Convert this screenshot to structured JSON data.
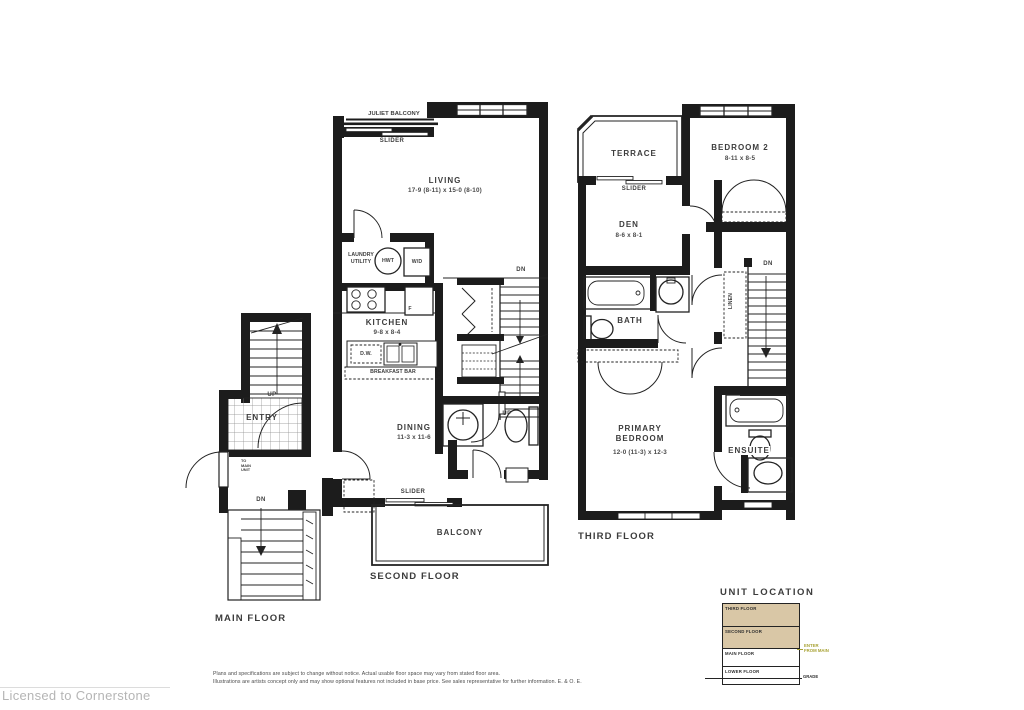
{
  "second_floor": {
    "title": "SECOND FLOOR",
    "juliet_balcony": "JULIET BALCONY",
    "slider_top": "SLIDER",
    "living_name": "LIVING",
    "living_dims": "17-9 (8-11) x 15-0 (8-10)",
    "laundry_line1": "LAUNDRY",
    "laundry_line2": "UTILITY",
    "hwt": "HWT",
    "washer_dryer": "W/D",
    "stairs_dn": "DN",
    "stairs_up": "UP",
    "kitchen_name": "KITCHEN",
    "kitchen_dims": "9-8 x 8-4",
    "fridge": "F",
    "dishwasher": "D.W.",
    "breakfast_bar": "BREAKFAST BAR",
    "dining_name": "DINING",
    "dining_dims": "11-3 x 11-6",
    "slider_bottom": "SLIDER",
    "balcony_name": "BALCONY"
  },
  "main_floor": {
    "title": "MAIN FLOOR",
    "stairs_up": "UP",
    "entry_name": "ENTRY",
    "to_main_unit": [
      "TO",
      "MAIN",
      "UNIT"
    ],
    "stairs_dn": "DN"
  },
  "third_floor": {
    "title": "THIRD FLOOR",
    "terrace_name": "TERRACE",
    "slider": "SLIDER",
    "bedroom2_name": "BEDROOM 2",
    "bedroom2_dims": "8-11 x 8-5",
    "den_name": "DEN",
    "den_dims": "8-6 x 8-1",
    "stairs_dn": "DN",
    "bath_name": "BATH",
    "linen": "LINEN",
    "primary_line1": "PRIMARY",
    "primary_line2": "BEDROOM",
    "primary_dims": "12-0 (11-3) x 12-3",
    "ensuite_name": "ENSUITE"
  },
  "unit_location": {
    "title": "UNIT LOCATION",
    "floors": [
      {
        "label": "THIRD FLOOR",
        "highlighted": true
      },
      {
        "label": "SECOND FLOOR",
        "highlighted": true
      },
      {
        "label": "MAIN FLOOR",
        "highlighted": false
      },
      {
        "label": "LOWER FLOOR",
        "highlighted": false
      }
    ],
    "highlight_color": "#d9c7a6",
    "annotation_color": "#a8a234",
    "annotation_line1": "ENTER",
    "annotation_line2": "FROM MAIN",
    "grade_label": "GRADE"
  },
  "footer": {
    "disclaimer_line1": "Plans and specifications are subject to change without notice. Actual usable floor space may vary from stated floor area.",
    "disclaimer_line2": "Illustrations are artists concept only and may show optional features not included in base price. See sales representative for further information. E. & O. E.",
    "license": "Licensed to Cornerstone"
  }
}
